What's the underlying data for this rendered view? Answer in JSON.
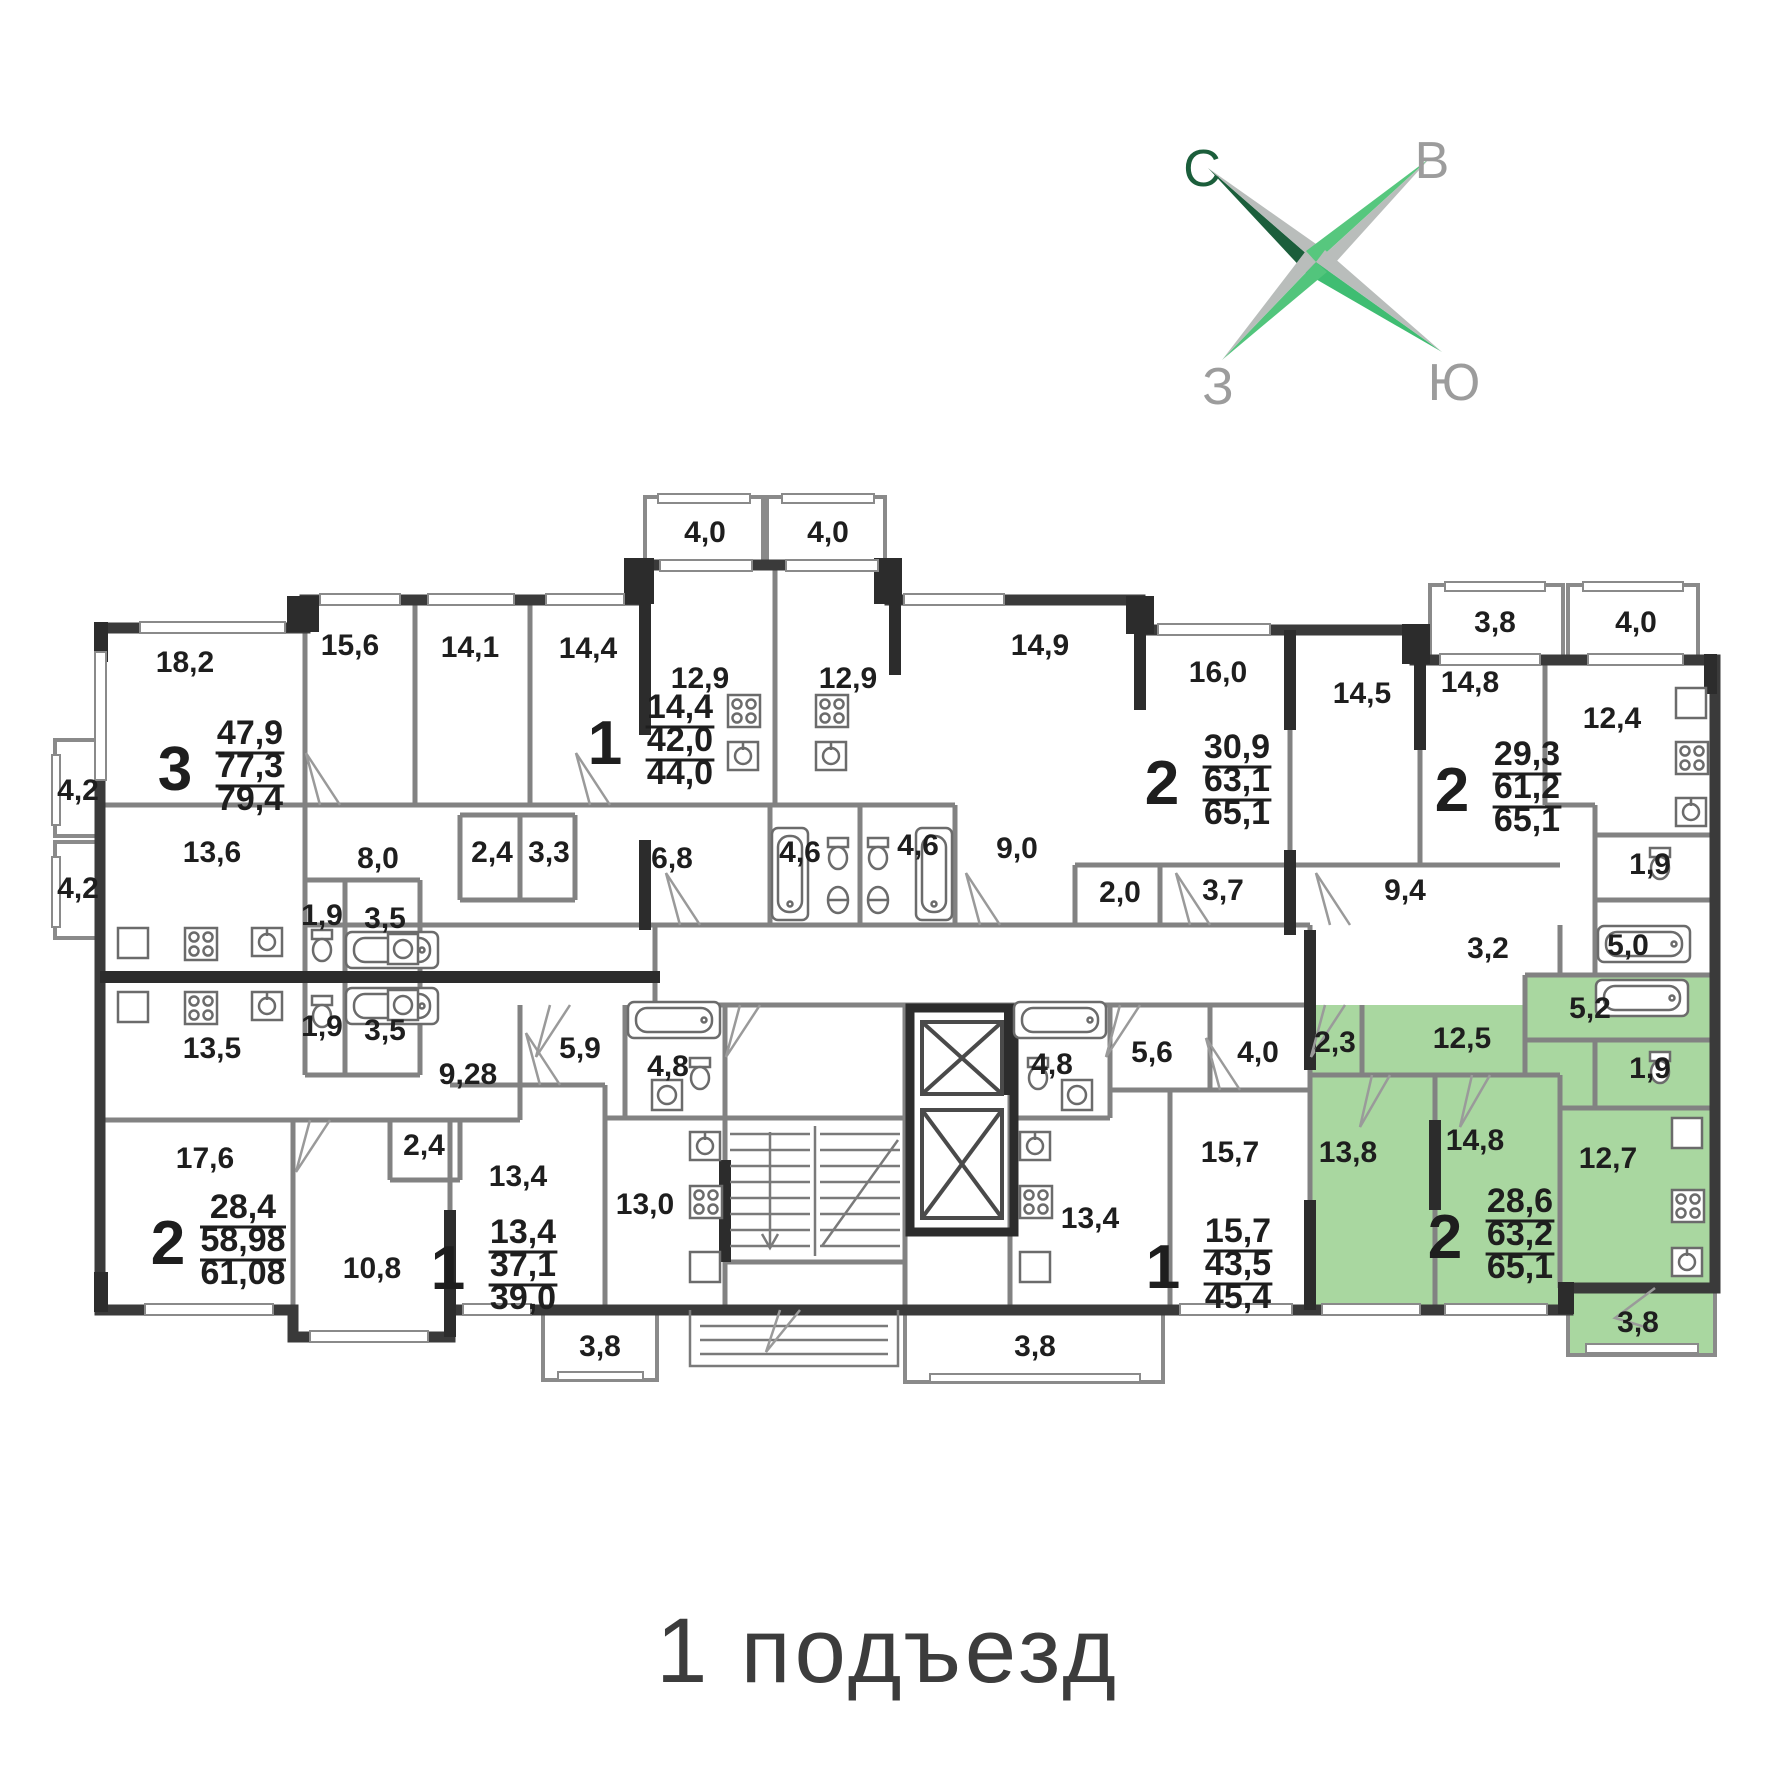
{
  "caption": {
    "text": "1 подъезд"
  },
  "compass": {
    "north": "С",
    "east": "В",
    "west": "З",
    "south": "Ю"
  },
  "colors": {
    "highlight_green": "#a9d7a0",
    "wall_dark": "#3a3a3a",
    "wall_gray": "#828282",
    "label_text": "#1e1e1e",
    "caption_text": "#3c3c3c",
    "compass_dark_green": "#1b5e3b",
    "compass_green": "#4fc47c",
    "compass_gray": "#b9bdbb"
  },
  "apartments": [
    {
      "rooms": "3",
      "living": "47,9",
      "area": "77,3",
      "total": "79,4",
      "highlighted": false,
      "x": 250,
      "y": 744
    },
    {
      "rooms": "1",
      "living": "14,4",
      "area": "42,0",
      "total": "44,0",
      "highlighted": false,
      "x": 680,
      "y": 718
    },
    {
      "rooms": "2",
      "living": "30,9",
      "area": "63,1",
      "total": "65,1",
      "highlighted": false,
      "x": 1237,
      "y": 758
    },
    {
      "rooms": "2",
      "living": "29,3",
      "area": "61,2",
      "total": "65,1",
      "highlighted": false,
      "x": 1527,
      "y": 765
    },
    {
      "rooms": "2",
      "living": "28,4",
      "area": "58,98",
      "total": "61,08",
      "highlighted": false,
      "x": 243,
      "y": 1218
    },
    {
      "rooms": "1",
      "living": "13,4",
      "area": "37,1",
      "total": "39,0",
      "highlighted": false,
      "x": 523,
      "y": 1243
    },
    {
      "rooms": "1",
      "living": "15,7",
      "area": "43,5",
      "total": "45,4",
      "highlighted": false,
      "x": 1238,
      "y": 1242
    },
    {
      "rooms": "2",
      "living": "28,6",
      "area": "63,2",
      "total": "65,1",
      "highlighted": true,
      "x": 1520,
      "y": 1212
    }
  ],
  "room_labels": [
    {
      "t": "18,2",
      "x": 185,
      "y": 672
    },
    {
      "t": "15,6",
      "x": 350,
      "y": 655
    },
    {
      "t": "14,1",
      "x": 470,
      "y": 657
    },
    {
      "t": "14,4",
      "x": 588,
      "y": 658
    },
    {
      "t": "4,0",
      "x": 705,
      "y": 542
    },
    {
      "t": "4,0",
      "x": 828,
      "y": 542
    },
    {
      "t": "12,9",
      "x": 700,
      "y": 688
    },
    {
      "t": "12,9",
      "x": 848,
      "y": 688
    },
    {
      "t": "14,9",
      "x": 1040,
      "y": 655
    },
    {
      "t": "16,0",
      "x": 1218,
      "y": 682
    },
    {
      "t": "14,5",
      "x": 1362,
      "y": 703
    },
    {
      "t": "3,8",
      "x": 1495,
      "y": 632
    },
    {
      "t": "4,0",
      "x": 1636,
      "y": 632
    },
    {
      "t": "14,8",
      "x": 1470,
      "y": 692
    },
    {
      "t": "12,4",
      "x": 1612,
      "y": 728
    },
    {
      "t": "4,2",
      "x": 78,
      "y": 800,
      "fs": 26
    },
    {
      "t": "4,2",
      "x": 78,
      "y": 898,
      "fs": 26
    },
    {
      "t": "13,6",
      "x": 212,
      "y": 862
    },
    {
      "t": "8,0",
      "x": 378,
      "y": 868
    },
    {
      "t": "1,9",
      "x": 322,
      "y": 925,
      "fs": 27
    },
    {
      "t": "3,5",
      "x": 385,
      "y": 928,
      "fs": 27
    },
    {
      "t": "2,4",
      "x": 492,
      "y": 862
    },
    {
      "t": "3,3",
      "x": 549,
      "y": 862
    },
    {
      "t": "6,8",
      "x": 672,
      "y": 868
    },
    {
      "t": "4,6",
      "x": 800,
      "y": 862
    },
    {
      "t": "4,6",
      "x": 918,
      "y": 855
    },
    {
      "t": "9,0",
      "x": 1017,
      "y": 858
    },
    {
      "t": "2,0",
      "x": 1120,
      "y": 902
    },
    {
      "t": "3,7",
      "x": 1223,
      "y": 900
    },
    {
      "t": "9,4",
      "x": 1405,
      "y": 900
    },
    {
      "t": "3,2",
      "x": 1488,
      "y": 958
    },
    {
      "t": "5,0",
      "x": 1628,
      "y": 955
    },
    {
      "t": "1,9",
      "x": 1650,
      "y": 874
    },
    {
      "t": "13,5",
      "x": 212,
      "y": 1058
    },
    {
      "t": "1,9",
      "x": 322,
      "y": 1036,
      "fs": 27
    },
    {
      "t": "3,5",
      "x": 385,
      "y": 1040,
      "fs": 27
    },
    {
      "t": "9,28",
      "x": 468,
      "y": 1084
    },
    {
      "t": "2,4",
      "x": 424,
      "y": 1155
    },
    {
      "t": "17,6",
      "x": 205,
      "y": 1168
    },
    {
      "t": "10,8",
      "x": 372,
      "y": 1278
    },
    {
      "t": "5,9",
      "x": 580,
      "y": 1058
    },
    {
      "t": "4,8",
      "x": 668,
      "y": 1076
    },
    {
      "t": "13,4",
      "x": 518,
      "y": 1186
    },
    {
      "t": "13,0",
      "x": 645,
      "y": 1214
    },
    {
      "t": "3,8",
      "x": 600,
      "y": 1356
    },
    {
      "t": "4,8",
      "x": 1052,
      "y": 1074
    },
    {
      "t": "5,6",
      "x": 1152,
      "y": 1062
    },
    {
      "t": "4,0",
      "x": 1258,
      "y": 1062
    },
    {
      "t": "13,4",
      "x": 1090,
      "y": 1228
    },
    {
      "t": "15,7",
      "x": 1230,
      "y": 1162
    },
    {
      "t": "3,8",
      "x": 1035,
      "y": 1356
    },
    {
      "t": "2,3",
      "x": 1335,
      "y": 1052
    },
    {
      "t": "12,5",
      "x": 1462,
      "y": 1048
    },
    {
      "t": "5,2",
      "x": 1590,
      "y": 1018
    },
    {
      "t": "1,9",
      "x": 1650,
      "y": 1078
    },
    {
      "t": "13,8",
      "x": 1348,
      "y": 1162
    },
    {
      "t": "14,8",
      "x": 1475,
      "y": 1150
    },
    {
      "t": "12,7",
      "x": 1608,
      "y": 1168
    },
    {
      "t": "3,8",
      "x": 1638,
      "y": 1332
    }
  ]
}
